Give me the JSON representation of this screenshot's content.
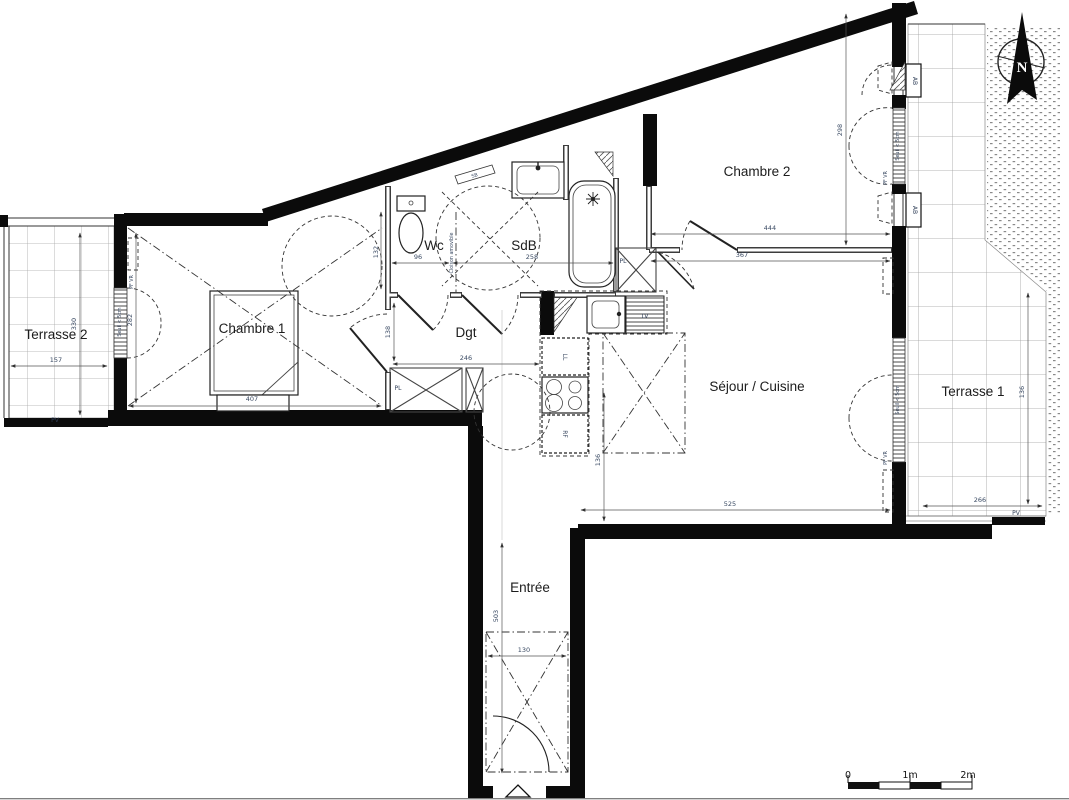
{
  "rooms": {
    "terrasse2": "Terrasse 2",
    "chambre1": "Chambre 1",
    "wc": "Wc",
    "sdb": "SdB",
    "dgt": "Dgt",
    "chambre2": "Chambre 2",
    "sejour": "Séjour / Cuisine",
    "entree": "Entrée",
    "terrasse1": "Terrasse 1"
  },
  "dims": {
    "terrasse2_w": "157",
    "terrasse2_h": "330",
    "chambre1_w": "407",
    "chambre1_h": "282",
    "wc_w": "96",
    "wc_h": "132",
    "sdb_w": "258",
    "dgt_w": "246",
    "dgt_h": "138",
    "chambre2_w": "444",
    "chambre2_h": "298",
    "sejour_w_top": "367",
    "sejour_w_bottom": "525",
    "sejour_h": "136",
    "entree_h": "503",
    "entree_w": "130",
    "terrasse1_w": "266",
    "terrasse1_h": "136"
  },
  "tags": {
    "pv": "PV",
    "pl": "PL",
    "ab": "AB",
    "pf_vr": "PF VR",
    "sb": "SB",
    "ll": "LL",
    "lv": "LV",
    "rf": "RF",
    "cloison": "Cloison amovible",
    "seuil": "Seuil < 5cm"
  },
  "north": {
    "letter": "N"
  },
  "scalebar": {
    "zero": "0",
    "one": "1m",
    "two": "2m"
  }
}
